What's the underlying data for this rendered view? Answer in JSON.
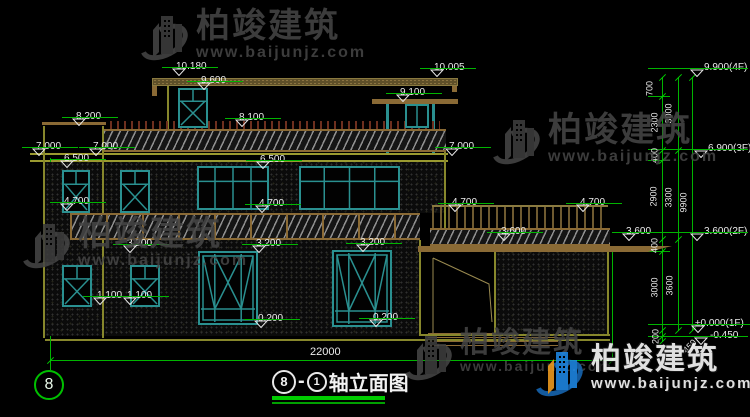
{
  "watermark": {
    "brand": "柏竣建筑",
    "url": "www.baijunjz.com"
  },
  "title": {
    "axis_start": "8",
    "separator": "-",
    "axis_end": "1",
    "name": "轴立面图"
  },
  "axis_bubble": "8",
  "overall_dimension": "22000",
  "level_markers": [
    {
      "text": "10.180",
      "x": 176,
      "y": 56
    },
    {
      "text": "9.600",
      "x": 201,
      "y": 70
    },
    {
      "text": "10.005",
      "x": 434,
      "y": 57
    },
    {
      "text": "9.100",
      "x": 400,
      "y": 82
    },
    {
      "text": "8.200",
      "x": 76,
      "y": 106
    },
    {
      "text": "8.100",
      "x": 239,
      "y": 107
    },
    {
      "text": "7.000",
      "x": 36,
      "y": 136
    },
    {
      "text": "7.000",
      "x": 93,
      "y": 136
    },
    {
      "text": "6.500",
      "x": 64,
      "y": 148
    },
    {
      "text": "6.500",
      "x": 260,
      "y": 149
    },
    {
      "text": "7.000",
      "x": 449,
      "y": 136
    },
    {
      "text": "4.700",
      "x": 64,
      "y": 191
    },
    {
      "text": "4.700",
      "x": 259,
      "y": 193
    },
    {
      "text": "4.700",
      "x": 452,
      "y": 192
    },
    {
      "text": "4.700",
      "x": 580,
      "y": 192
    },
    {
      "text": "3.200",
      "x": 127,
      "y": 233
    },
    {
      "text": "3.200",
      "x": 256,
      "y": 233
    },
    {
      "text": "3.200",
      "x": 360,
      "y": 232
    },
    {
      "text": "3.600",
      "x": 501,
      "y": 221
    },
    {
      "text": "3.600",
      "x": 626,
      "y": 221
    },
    {
      "text": "1.100",
      "x": 97,
      "y": 285
    },
    {
      "text": "1.100",
      "x": 127,
      "y": 285
    },
    {
      "text": "0.200",
      "x": 258,
      "y": 308
    },
    {
      "text": "0.200",
      "x": 373,
      "y": 307
    }
  ],
  "floor_levels": [
    {
      "text": "9.900(4F)",
      "x": 704,
      "y": 57,
      "lx": -56,
      "lw": 100,
      "tx": -14
    },
    {
      "text": "6.900(3F)",
      "x": 708,
      "y": 138,
      "lx": -60,
      "lw": 100,
      "tx": -14
    },
    {
      "text": "3.600(2F)",
      "x": 704,
      "y": 221,
      "lx": -56,
      "lw": 100,
      "tx": -14
    },
    {
      "text": "±0.000(1F)",
      "x": 695,
      "y": 313,
      "lx": -47,
      "lw": 102,
      "tx": -4
    },
    {
      "text": "-0.450",
      "x": 710,
      "y": 325,
      "lx": -62,
      "lw": 100,
      "tx": -16
    }
  ],
  "chain_dims": [
    {
      "text": "700",
      "x": 650,
      "y": 89,
      "rot": -90
    },
    {
      "text": "2300",
      "x": 655,
      "y": 123,
      "rot": -90
    },
    {
      "text": "3000",
      "x": 669,
      "y": 114,
      "rot": -90
    },
    {
      "text": "400",
      "x": 655,
      "y": 156,
      "rot": -90
    },
    {
      "text": "2900",
      "x": 654,
      "y": 197,
      "rot": -90
    },
    {
      "text": "3300",
      "x": 669,
      "y": 198,
      "rot": -90
    },
    {
      "text": "9900",
      "x": 684,
      "y": 203,
      "rot": -90
    },
    {
      "text": "400",
      "x": 655,
      "y": 246,
      "rot": -90
    },
    {
      "text": "3000",
      "x": 655,
      "y": 288,
      "rot": -90
    },
    {
      "text": "3600",
      "x": 670,
      "y": 286,
      "rot": -90
    },
    {
      "text": "200",
      "x": 656,
      "y": 337,
      "rot": -90
    },
    {
      "text": "450",
      "x": 690,
      "y": 347,
      "rot": -45
    }
  ],
  "colors": {
    "dim_green": "#00b400",
    "window_teal": "#2a9090",
    "wall_olive": "#87872c",
    "roof_tan": "#8a6a35",
    "logo_blue": "#1767b3",
    "logo_orange": "#f29d1e"
  }
}
